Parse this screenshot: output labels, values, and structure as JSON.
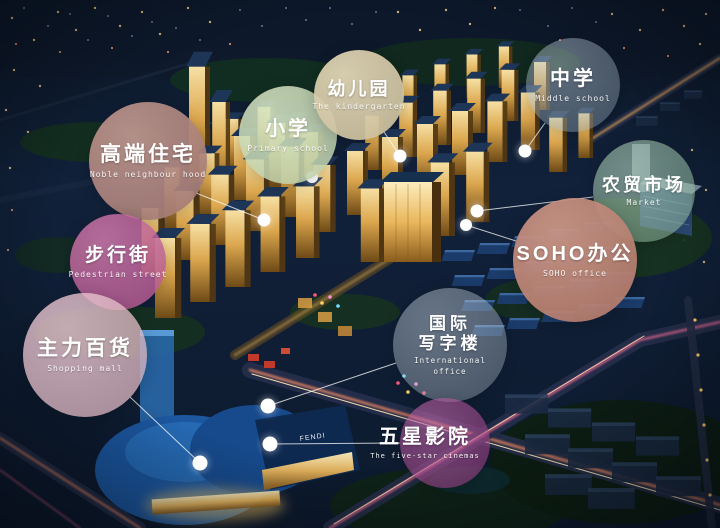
{
  "scene": {
    "signage_fendi": "FENDI"
  },
  "labels": {
    "noble": {
      "zh": "高端住宅",
      "en": "Noble neighbour hood",
      "color": "#B2837C",
      "fill": "rgba(178,131,124,0.92)"
    },
    "primary": {
      "zh": "小学",
      "en": "Primary school",
      "color": "#CEE2B8",
      "fill": "rgba(206,226,184,0.85)"
    },
    "kindergarten": {
      "zh": "幼儿园",
      "en": "The kindergarten",
      "color": "#DED0AA",
      "fill": "rgba(222,208,170,0.92)"
    },
    "middle": {
      "zh": "中学",
      "en": "Middle school",
      "color": "#AABED0",
      "fill": "rgba(170,190,208,0.36)"
    },
    "market": {
      "zh": "农贸市场",
      "en": "Market",
      "color": "#9ECBAA",
      "fill": "rgba(158,203,170,0.52)"
    },
    "soho": {
      "zh": "SOHO办公",
      "en": "SOHO office",
      "color": "#C38372",
      "fill": "rgba(195,131,114,0.93)"
    },
    "pedestrian": {
      "zh": "步行街",
      "en": "Pedestrian street",
      "color": "#C75E9E",
      "fill": "rgba(199,94,158,0.82)"
    },
    "shopping": {
      "zh": "主力百货",
      "en": "Shopping mall",
      "color": "#F0C4D0",
      "fill": "rgba(240,196,208,0.75)"
    },
    "international": {
      "zh1": "国际",
      "zh2": "写字楼",
      "en1": "International",
      "en2": "office",
      "color": "#C6D8E8",
      "fill": "rgba(198,216,232,0.34)"
    },
    "cinema": {
      "zh": "五星影院",
      "en": "The five-star cinemas",
      "color": "#AF3E91",
      "fill": "rgba(175,62,145,0.55)"
    }
  }
}
